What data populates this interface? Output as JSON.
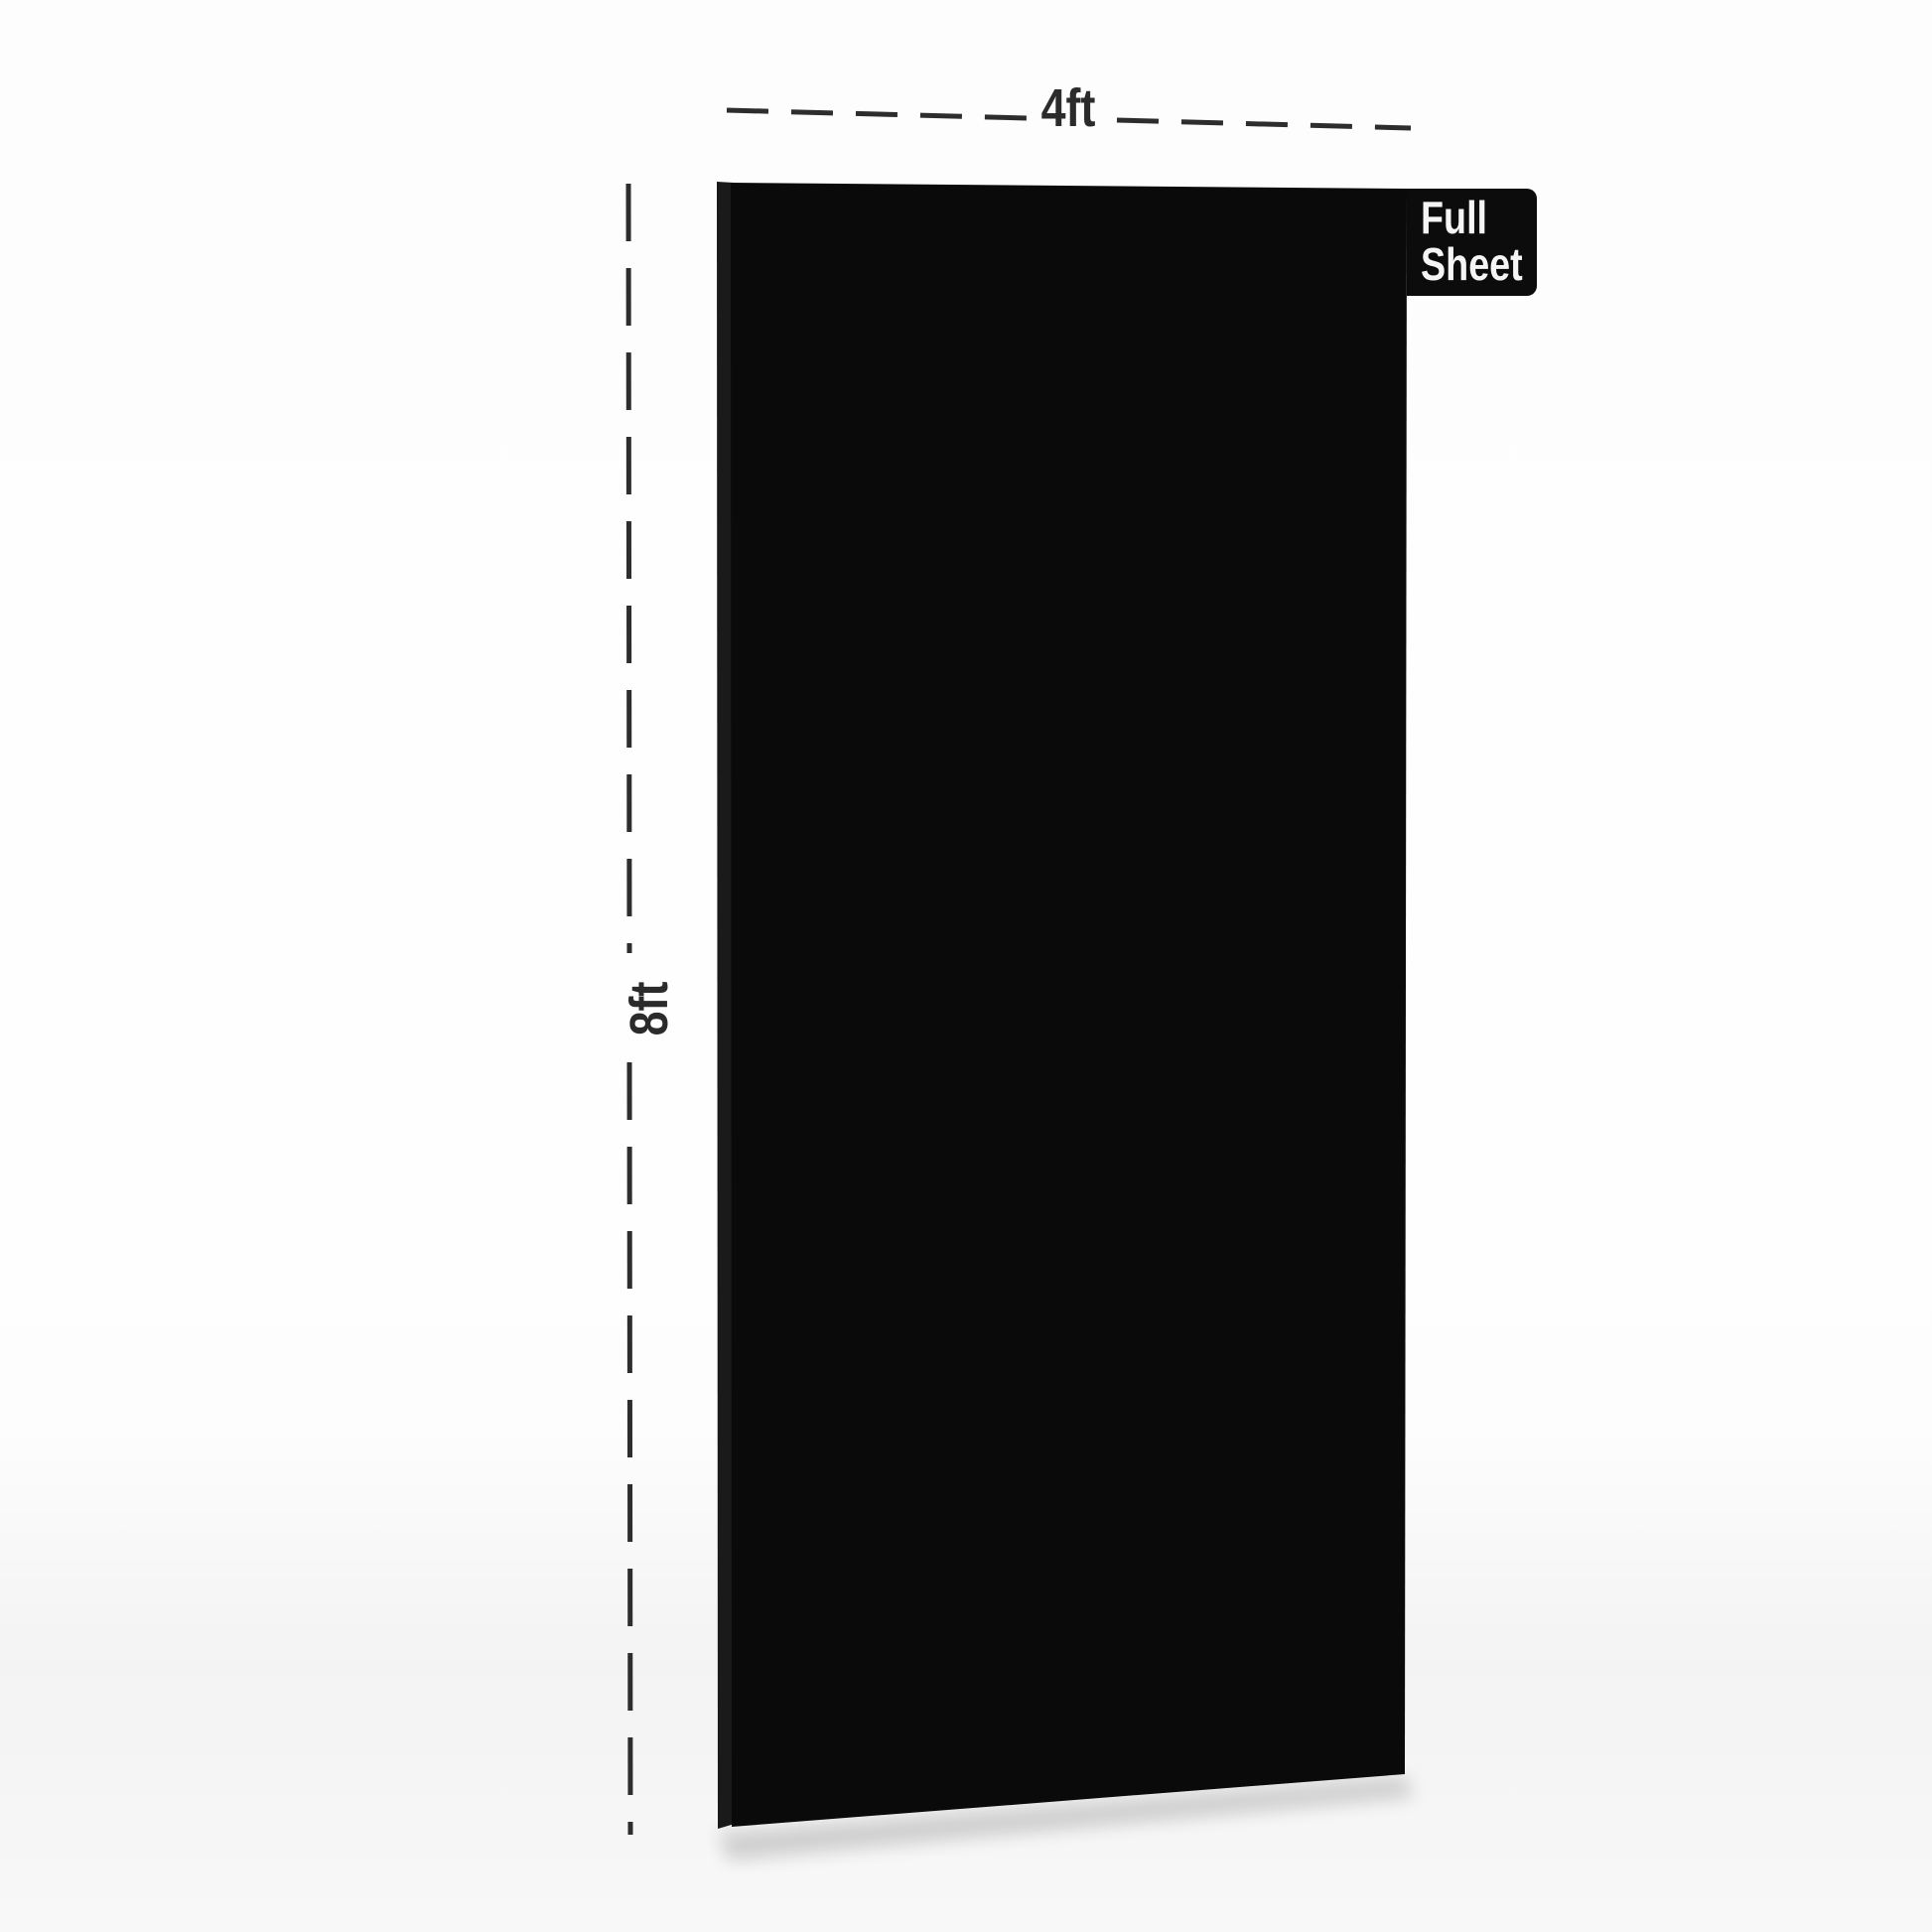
{
  "diagram": {
    "width_dimension": {
      "label": "4ft"
    },
    "height_dimension": {
      "label": "8ft"
    },
    "badge": {
      "line1": "Full",
      "line2": "Sheet"
    },
    "colors": {
      "background": "#fdfdfd",
      "sheet_face": "#0a0a0a",
      "sheet_side_edge": "#1a1a1a",
      "badge_background": "#0c0c0c",
      "badge_text": "#f5f5f5",
      "dimension_line": "#2d2d2d",
      "shadow": "#000000"
    }
  }
}
